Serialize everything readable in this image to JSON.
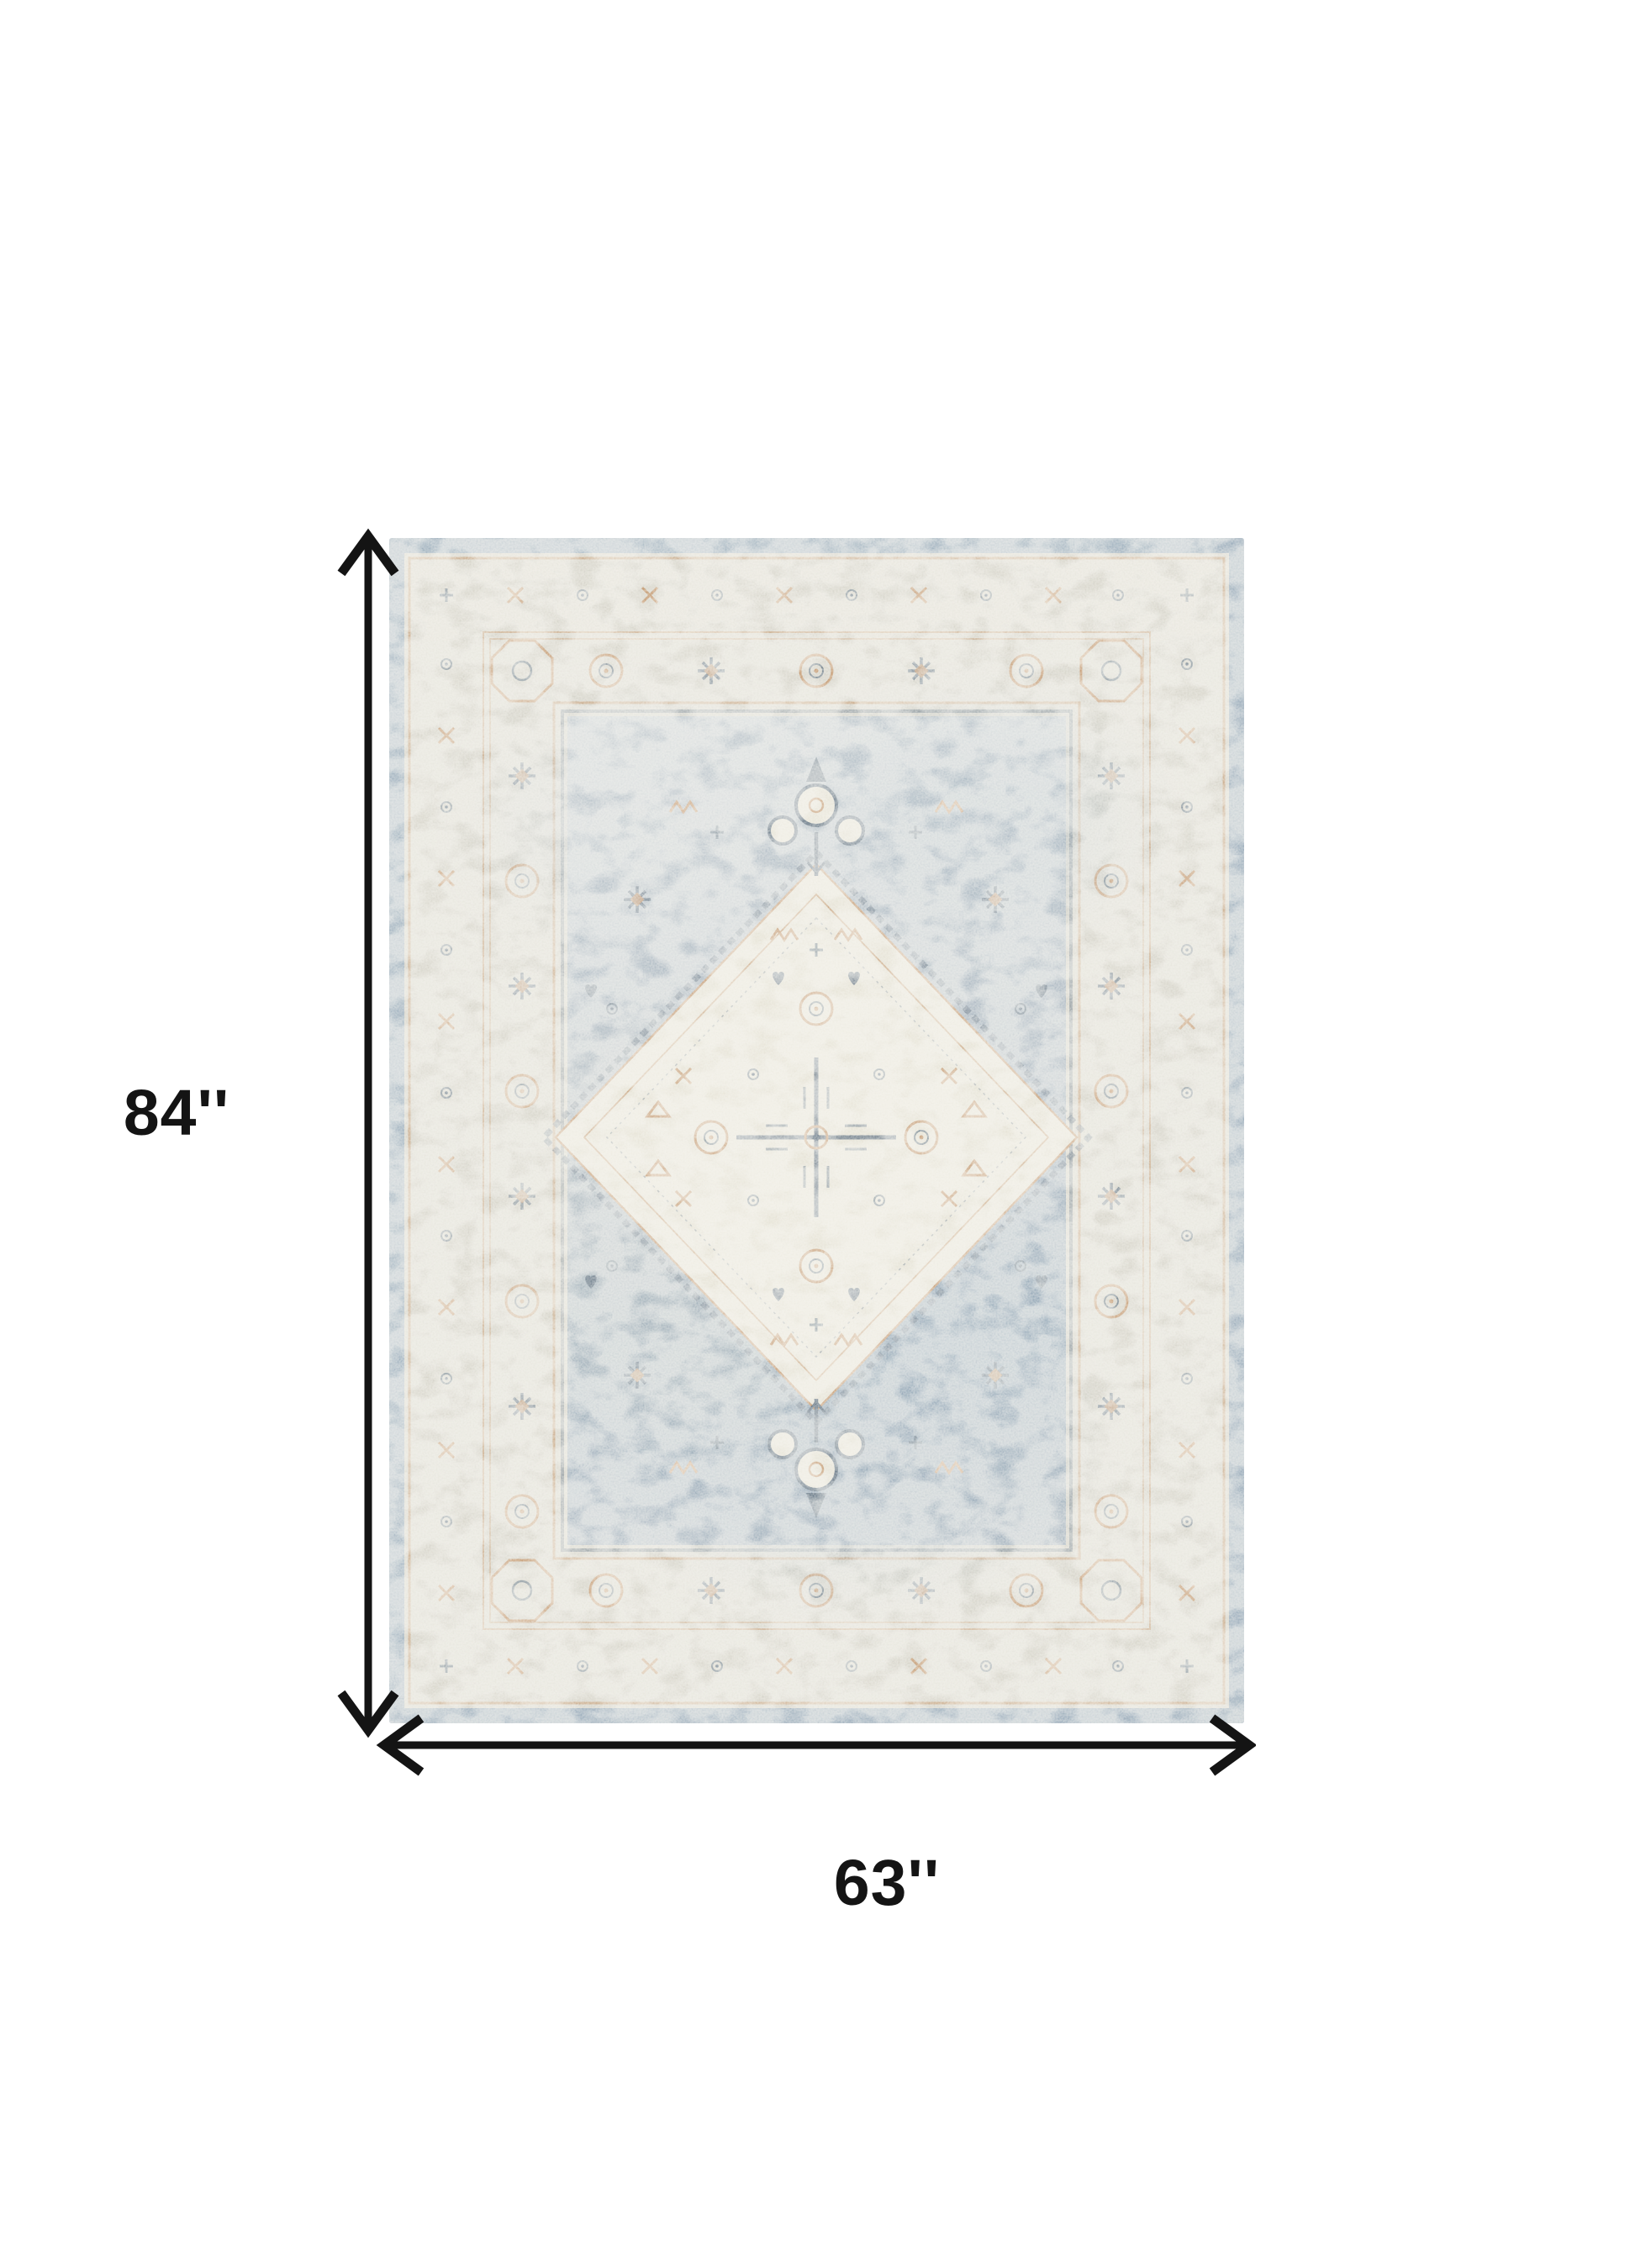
{
  "page": {
    "background": "#ffffff"
  },
  "product": {
    "name": "vintage-distressed-medallion-area-rug",
    "appearance": "light blue, gray and ivory distressed oriental rug with center diamond medallion and tan accents"
  },
  "dimensions": {
    "height_label": "84''",
    "width_label": "63''",
    "height_inches": 84,
    "width_inches": 63
  },
  "colors": {
    "page_background": "#ffffff",
    "annotation_black": "#141414",
    "rug_edge_blue": "#9eb0be",
    "rug_border_cream": "#d7d5cb",
    "rug_field_blue_light": "#bfc8ce",
    "rug_field_blue": "#a9b6c1",
    "rug_field_blue_deep": "#8fa4b5",
    "rug_medallion_cream": "#e6e3d6",
    "rug_accent_tan": "#c2976e",
    "rug_accent_slate": "#5e7080"
  }
}
